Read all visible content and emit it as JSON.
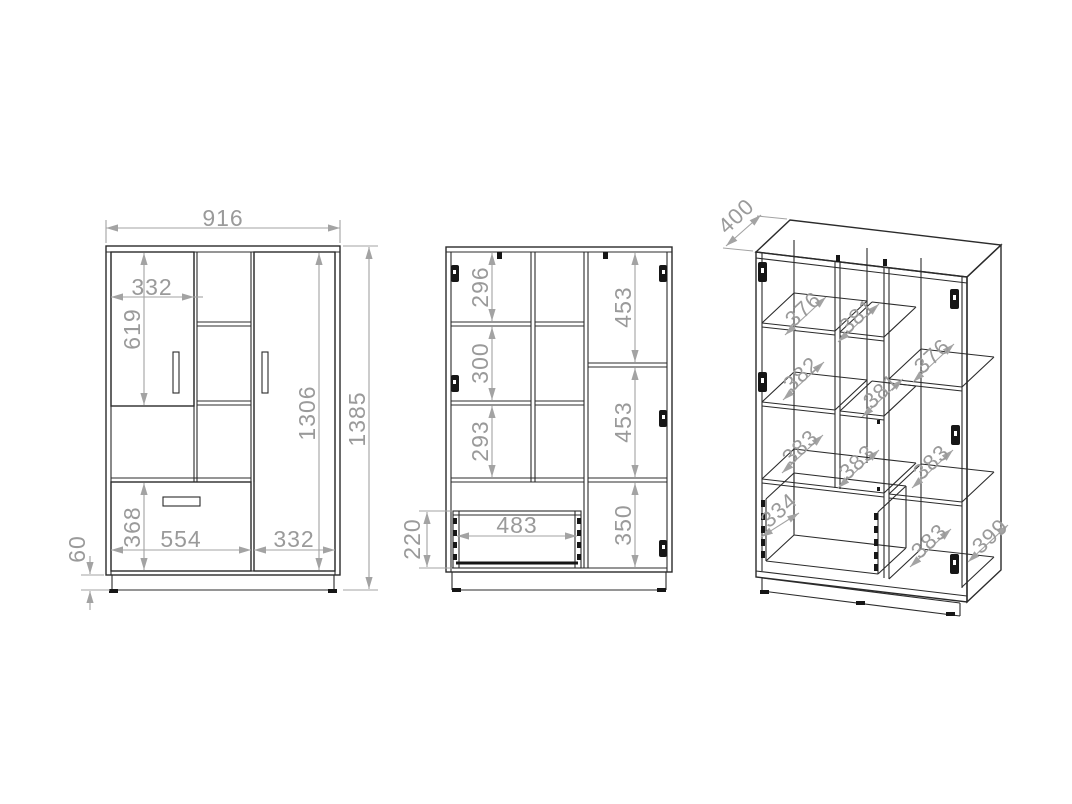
{
  "drawing": {
    "title": "wardrobe-technical-drawing",
    "colors": {
      "line": "#2b2b2b",
      "dimension": "#9a9a9a",
      "background": "#ffffff"
    },
    "front_view": {
      "total_width": "916",
      "total_height": "1385",
      "left_door_width": "332",
      "left_door_height": "619",
      "right_door_height": "1306",
      "drawer_front_height": "368",
      "drawer_section_width": "554",
      "right_door_width": "332",
      "plinth_height": "60"
    },
    "interior_view": {
      "left_top_compartment": "296",
      "left_middle_compartment": "300",
      "left_bottom_compartment": "293",
      "right_top_compartment": "453",
      "right_middle_compartment": "453",
      "right_bottom_compartment": "350",
      "drawer_inner_width": "483",
      "drawer_box_height": "220"
    },
    "perspective_view": {
      "total_depth": "400",
      "left_shelf_top_depth": "376",
      "left_shelf_middle_depth": "382",
      "left_shelf_bottom_depth": "383",
      "middle_shelf_top_depth": "381",
      "middle_shelf_middle_depth": "381",
      "middle_shelf_bottom_depth": "383",
      "right_shelf_top_depth": "376",
      "right_shelf_middle_depth": "383",
      "right_shelf_bottom_depth": "383",
      "drawer_depth": "334",
      "base_depth": "399"
    }
  }
}
